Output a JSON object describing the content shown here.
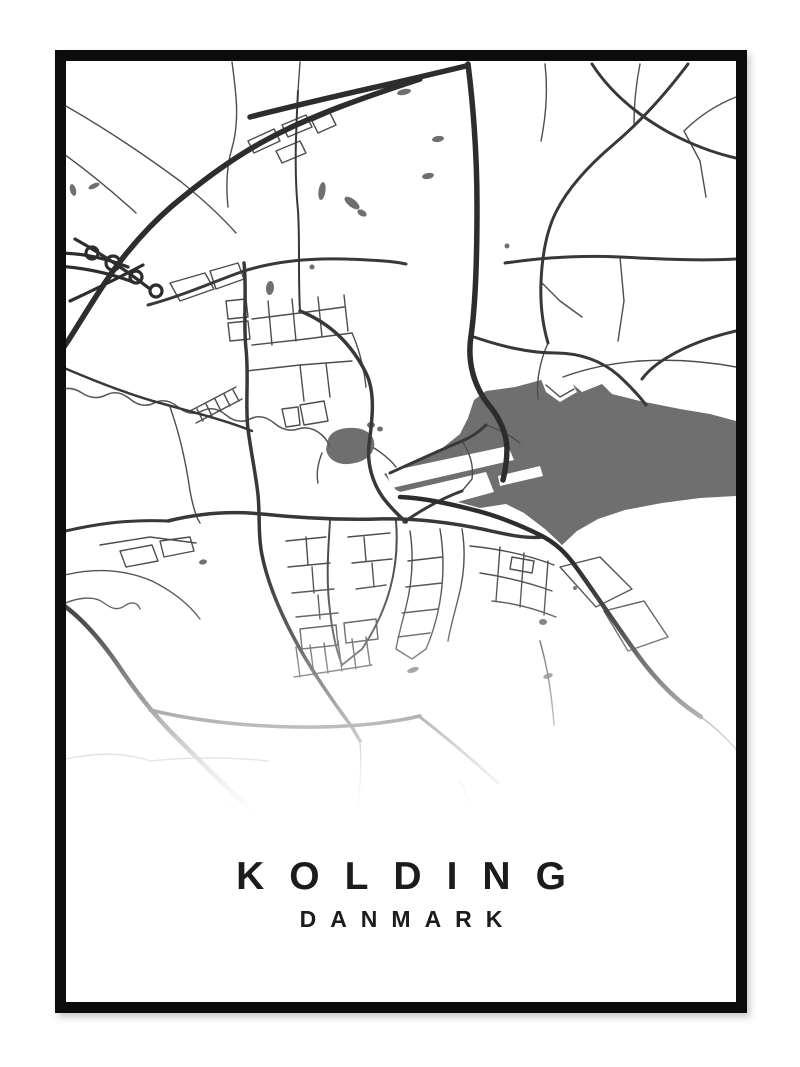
{
  "poster": {
    "title": "KOLDING",
    "subtitle": "DANMARK"
  },
  "colors": {
    "page_background": "#ffffff",
    "paper": "#ffffff",
    "frame": "#0c0c0c",
    "water": "#6f6f6f",
    "road_motorway": "#2d2d2d",
    "road_major": "#383838",
    "road_minor": "#4d4d4d",
    "river": "#5a5a5a",
    "text": "#1c1c1c"
  }
}
